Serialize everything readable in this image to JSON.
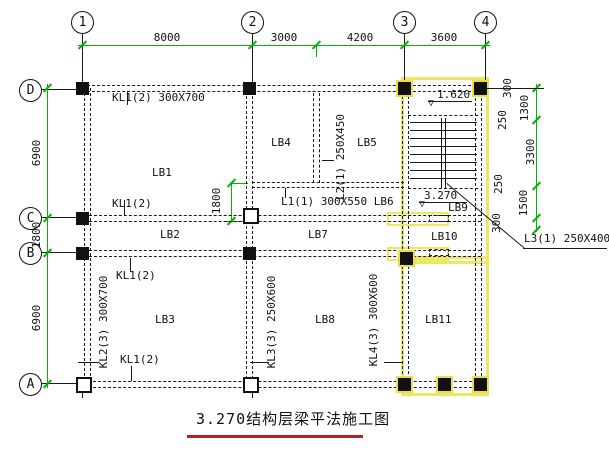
{
  "title": {
    "text": "3.270结构层梁平法施工图"
  },
  "axes": {
    "top": [
      "1",
      "2",
      "3",
      "4"
    ],
    "left": [
      "D",
      "C",
      "B",
      "A"
    ]
  },
  "dims": {
    "top": [
      "8000",
      "3000",
      "4200",
      "3600"
    ],
    "left": [
      "6900",
      "1800",
      "6900"
    ],
    "right": [
      "300",
      "250",
      "1300",
      "3300",
      "250",
      "1500",
      "300"
    ],
    "lb1_inner": "1800"
  },
  "slabs": {
    "lb1": "LB1",
    "lb2": "LB2",
    "lb3": "LB3",
    "lb4": "LB4",
    "lb5": "LB5",
    "lb7": "LB7",
    "lb8": "LB8",
    "lb9": "LB9",
    "lb10": "LB10",
    "lb11": "LB11"
  },
  "beams": {
    "kl1_full": "KL1(2) 300X700",
    "kl1": "KL1(2)",
    "kl2": "KL2(3) 300X700",
    "kl3": "KL3(3) 250X600",
    "kl4": "KL4(3) 300X600",
    "l1_lb6": "L1(1) 300X550 LB6",
    "l2": "L2(1) 250X450",
    "l3": "L3(1) 250X400"
  },
  "levels": {
    "upper": "1.620",
    "lower": "3.270"
  },
  "symbols": {
    "level_mark": "▽"
  },
  "colors": {
    "dim_green": "#00b400",
    "select_yellow": "#ece862",
    "title_underline": "#b22222"
  }
}
